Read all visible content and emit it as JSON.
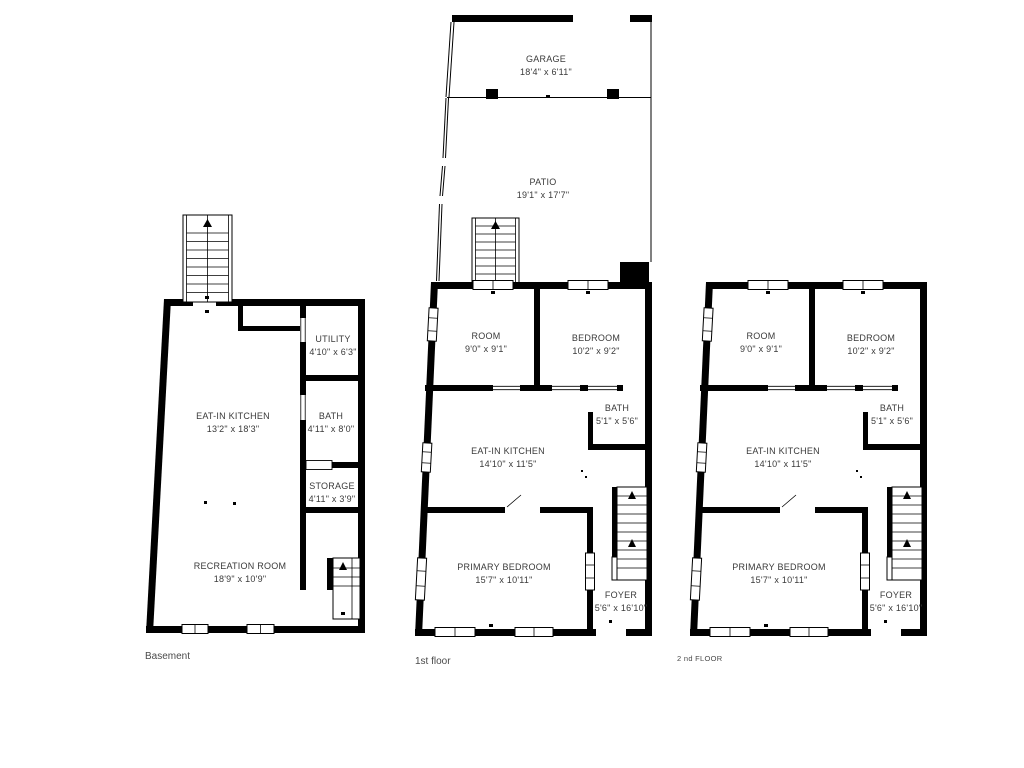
{
  "page": {
    "background_color": "#ffffff",
    "wall_color": "#000000",
    "label_color": "#3a3a3a",
    "caption_color": "#4a4a4a"
  },
  "icons": {
    "stairs_up_arrow": "triangle-up"
  },
  "floors": [
    {
      "id": "basement",
      "caption": "Basement",
      "rooms": [
        {
          "name": "EAT-IN KITCHEN",
          "dims": "13'2\" x 18'3\""
        },
        {
          "name": "UTILITY",
          "dims": "4'10\" x 6'3\""
        },
        {
          "name": "BATH",
          "dims": "4'11\" x 8'0\""
        },
        {
          "name": "STORAGE",
          "dims": "4'11\" x 3'9\""
        },
        {
          "name": "RECREATION ROOM",
          "dims": "18'9\" x 10'9\""
        }
      ]
    },
    {
      "id": "first-floor",
      "caption": "1st floor",
      "rooms": [
        {
          "name": "GARAGE",
          "dims": "18'4\" x 6'11\""
        },
        {
          "name": "PATIO",
          "dims": "19'1\" x 17'7\""
        },
        {
          "name": "ROOM",
          "dims": "9'0\" x 9'1\""
        },
        {
          "name": "BEDROOM",
          "dims": "10'2\" x 9'2\""
        },
        {
          "name": "BATH",
          "dims": "5'1\" x 5'6\""
        },
        {
          "name": "EAT-IN KITCHEN",
          "dims": "14'10\" x 11'5\""
        },
        {
          "name": "PRIMARY BEDROOM",
          "dims": "15'7\" x 10'11\""
        },
        {
          "name": "FOYER",
          "dims": "5'6\" x 16'10\""
        }
      ]
    },
    {
      "id": "second-floor",
      "caption": "2 nd FLOOR",
      "rooms": [
        {
          "name": "ROOM",
          "dims": "9'0\" x 9'1\""
        },
        {
          "name": "BEDROOM",
          "dims": "10'2\" x 9'2\""
        },
        {
          "name": "BATH",
          "dims": "5'1\" x 5'6\""
        },
        {
          "name": "EAT-IN KITCHEN",
          "dims": "14'10\" x 11'5\""
        },
        {
          "name": "PRIMARY BEDROOM",
          "dims": "15'7\" x 10'11\""
        },
        {
          "name": "FOYER",
          "dims": "5'6\" x 16'10\""
        }
      ]
    }
  ]
}
